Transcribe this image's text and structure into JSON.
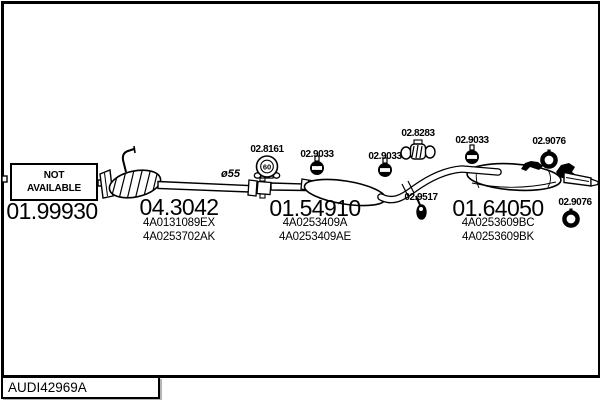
{
  "title_block": {
    "drawing_id": "AUDI42969A"
  },
  "parts": [
    {
      "number": "01.99930",
      "availability": "NOT AVAILABLE"
    },
    {
      "number": "04.3042",
      "codes": [
        "4A0131089EX",
        "4A0253702AK"
      ]
    },
    {
      "number": "01.54910",
      "codes": [
        "4A0253409A",
        "4A0253409AE"
      ]
    },
    {
      "number": "01.64050",
      "codes": [
        "4A0253609BC",
        "4A0253609BK"
      ]
    }
  ],
  "fittings": {
    "front_clamp": {
      "number": "02.8161",
      "size": "60"
    },
    "hanger_mid_front": {
      "number": "02.9033"
    },
    "hanger_mid_rear": {
      "number": "02.9033"
    },
    "rear_clamp": {
      "number": "02.8283"
    },
    "hanger_rear": {
      "number": "02.9033"
    },
    "ring_rear_top": {
      "number": "02.9076"
    },
    "mount_rear": {
      "number": "02.9517"
    },
    "ring_tail": {
      "number": "02.9076"
    }
  },
  "annotations": {
    "pipe_diameter": "ø55"
  },
  "colors": {
    "ink": "#000000",
    "paper": "#ffffff"
  }
}
